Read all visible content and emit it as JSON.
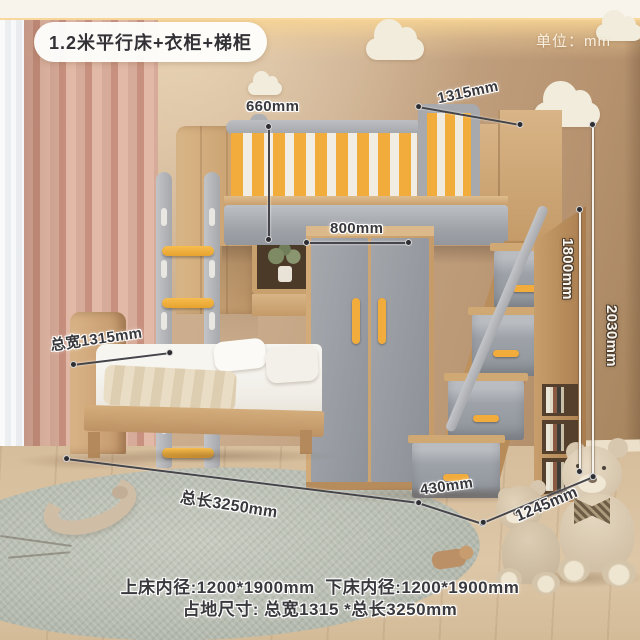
{
  "header": {
    "product_tag": "1.2米平行床+衣柜+梯柜",
    "unit_note": "单位：mm"
  },
  "dimensions": {
    "guardrail_height": "660mm",
    "upper_bed_width": "1315mm",
    "wardrobe_width": "800mm",
    "ladder_cabinet_height": "1800mm",
    "total_height": "2030mm",
    "total_width": "总宽1315mm",
    "total_length": "总长3250mm",
    "step_cabinet_width": "430mm",
    "step_cabinet_depth": "1245mm"
  },
  "footer": {
    "line1": "上床内径:1200*1900mm  下床内径:1200*1900mm",
    "line2": "占地尺寸: 总宽1315 *总长3250mm"
  },
  "colors": {
    "accent_yellow": "#f2ac3c",
    "furniture_gray": "#9da1a7",
    "wood": "#c9a06c",
    "wall": "#c7a888",
    "floor": "#d8c0a0",
    "curtain": "#d2a493",
    "rug": "#b7bcb1",
    "annotation_dark": "#3a3a3e",
    "annotation_light": "#f8f3e9"
  }
}
